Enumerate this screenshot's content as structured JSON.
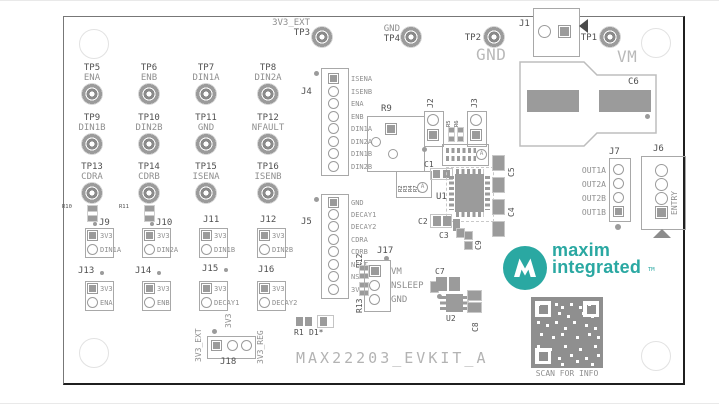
{
  "board": {
    "title": "MAX22203_EVKIT_A",
    "colors": {
      "teal": "#2AA8A2",
      "silkscreen": "#9B9B9B",
      "text_dark": "#4A4A4A",
      "text_light": "#B5B5B5"
    }
  },
  "top": {
    "tp3_net": "3V3_EXT",
    "tp3": "TP3",
    "tp4_net": "GND",
    "tp4": "TP4",
    "tp2": "TP2",
    "tp2_net": "GND",
    "j1": "J1",
    "tp1": "TP1",
    "tp1_net": "VM"
  },
  "tp_grid": [
    {
      "ref": "TP5",
      "net": "ENA"
    },
    {
      "ref": "TP6",
      "net": "ENB"
    },
    {
      "ref": "TP7",
      "net": "DIN1A"
    },
    {
      "ref": "TP8",
      "net": "DIN2A"
    },
    {
      "ref": "TP9",
      "net": "DIN1B"
    },
    {
      "ref": "TP10",
      "net": "DIN2B"
    },
    {
      "ref": "TP11",
      "net": "GND"
    },
    {
      "ref": "TP12",
      "net": "NFAULT"
    },
    {
      "ref": "TP13",
      "net": "CDRA"
    },
    {
      "ref": "TP14",
      "net": "CDRB"
    },
    {
      "ref": "TP15",
      "net": "ISENA"
    },
    {
      "ref": "TP16",
      "net": "ISENB"
    }
  ],
  "j4": {
    "ref": "J4",
    "pins": [
      "ISENA",
      "ISENB",
      "ENA",
      "ENB",
      "DIN1A",
      "DIN2A",
      "DIN1B",
      "DIN2B"
    ]
  },
  "j5": {
    "ref": "J5",
    "pins": [
      "GND",
      "DECAY1",
      "DECAY2",
      "CDRA",
      "CDRB",
      "NFLT",
      "NSLP",
      "3V3"
    ]
  },
  "j7": {
    "ref": "J7",
    "pins": [
      "OUT1A",
      "OUT2A",
      "OUT2B",
      "OUT1B"
    ]
  },
  "j6": {
    "ref": "J6",
    "label": "ENTRY"
  },
  "j2": {
    "ref": "J2"
  },
  "j3": {
    "ref": "J3"
  },
  "j17": {
    "ref": "J17",
    "pins": [
      "VM",
      "NSLEEP",
      "GND"
    ]
  },
  "j18": {
    "ref": "J18",
    "rails": [
      "3V3_EXT",
      "3V3",
      "3V3_REG"
    ]
  },
  "jumpers": [
    {
      "ref": "J9",
      "top": "3V3",
      "bottom": "DIN1A"
    },
    {
      "ref": "J10",
      "top": "3V3",
      "bottom": "DIN2A"
    },
    {
      "ref": "J11",
      "top": "3V3",
      "bottom": "DIN1B"
    },
    {
      "ref": "J12",
      "top": "3V3",
      "bottom": "DIN2B"
    },
    {
      "ref": "J13",
      "top": "3V3",
      "bottom": "ENA"
    },
    {
      "ref": "J14",
      "top": "3V3",
      "bottom": "ENB"
    },
    {
      "ref": "J15",
      "top": "3V3",
      "bottom": "DECAY1"
    },
    {
      "ref": "J16",
      "top": "3V3",
      "bottom": "DECAY2"
    }
  ],
  "components": {
    "r9": "R9",
    "r10": "R10",
    "r11": "R11",
    "r12": "R12",
    "r13": "R13",
    "r5": "R5",
    "r6": "R6",
    "r1": "R1",
    "d1": "D1*",
    "u1": "U1",
    "u2": "U2",
    "c1": "C1",
    "c2": "C2",
    "c3": "C3",
    "c4": "C4",
    "c5": "C5",
    "c6": "C6",
    "c7": "C7",
    "c8": "C8",
    "c9": "C9",
    "res_array": [
      "R2",
      "R3",
      "R4",
      "R7",
      "R8"
    ],
    "variant": "A"
  },
  "branding": {
    "logo_line1": "maxim",
    "logo_line2": "integrated",
    "trademark": "TM",
    "qr_caption": "SCAN FOR INFO"
  }
}
